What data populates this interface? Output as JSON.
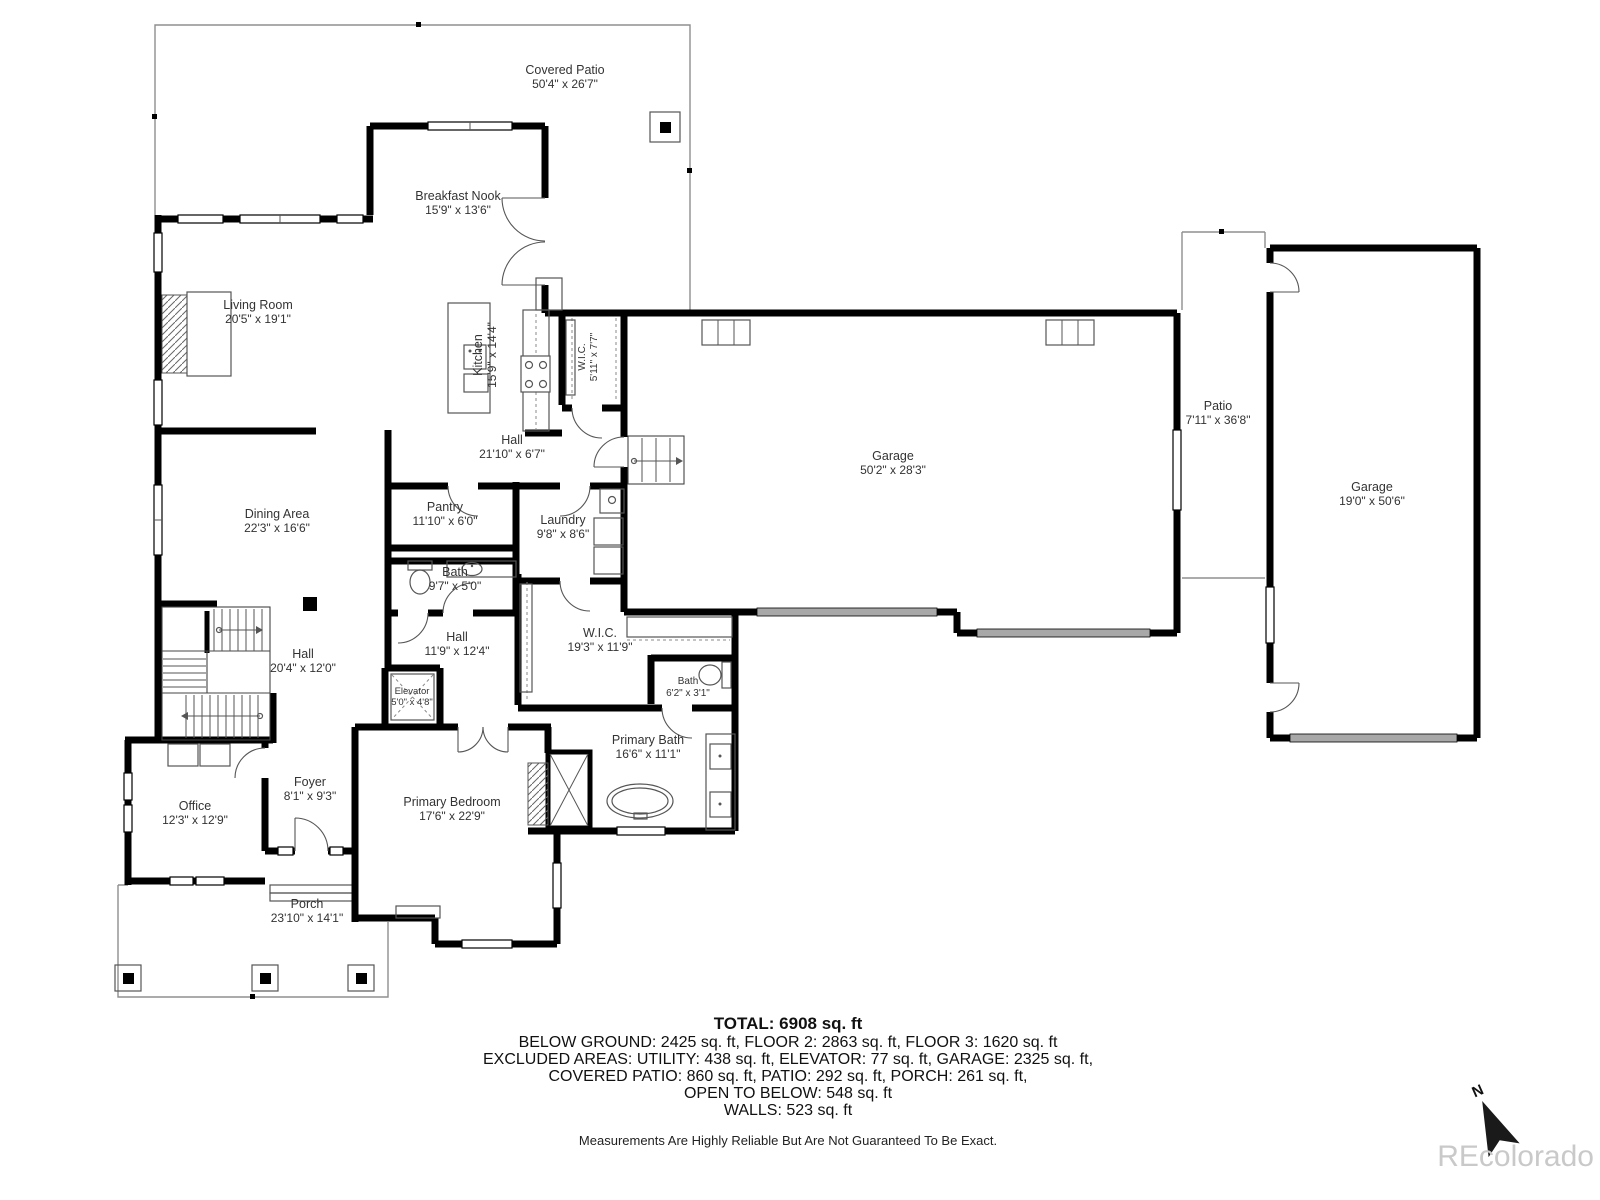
{
  "rooms": [
    {
      "name": "Covered Patio",
      "dims": "50'4\" x 26'7\""
    },
    {
      "name": "Breakfast Nook",
      "dims": "15'9\" x 13'6\""
    },
    {
      "name": "Living Room",
      "dims": "20'5\" x 19'1\""
    },
    {
      "name": "Kitchen",
      "dims": "15'9\" x 14'4\""
    },
    {
      "name": "W.I.C.",
      "dims": "5'11\" x 7'7\""
    },
    {
      "name": "Hall",
      "dims": "21'10\" x 6'7\""
    },
    {
      "name": "Garage",
      "dims": "50'2\" x 28'3\""
    },
    {
      "name": "Patio",
      "dims": "7'11\" x 36'8\""
    },
    {
      "name": "Garage",
      "dims": "19'0\" x 50'6\""
    },
    {
      "name": "Dining Area",
      "dims": "22'3\" x 16'6\""
    },
    {
      "name": "Pantry",
      "dims": "11'10\" x 6'0\""
    },
    {
      "name": "Laundry",
      "dims": "9'8\" x 8'6\""
    },
    {
      "name": "Bath",
      "dims": "9'7\" x 5'0\""
    },
    {
      "name": "Hall",
      "dims": "20'4\" x 12'0\""
    },
    {
      "name": "Hall",
      "dims": "11'9\" x 12'4\""
    },
    {
      "name": "W.I.C.",
      "dims": "19'3\" x 11'9\""
    },
    {
      "name": "Bath",
      "dims": "6'2\" x 3'1\""
    },
    {
      "name": "Elevator",
      "dims": "5'0\" x 4'8\""
    },
    {
      "name": "Primary Bath",
      "dims": "16'6\" x 11'1\""
    },
    {
      "name": "Primary Bedroom",
      "dims": "17'6\" x 22'9\""
    },
    {
      "name": "Office",
      "dims": "12'3\" x 12'9\""
    },
    {
      "name": "Foyer",
      "dims": "8'1\" x 9'3\""
    },
    {
      "name": "Porch",
      "dims": "23'10\" x 14'1\""
    }
  ],
  "summary": {
    "total": "TOTAL: 6908 sq. ft",
    "floors": "BELOW GROUND: 2425 sq. ft, FLOOR 2: 2863 sq. ft, FLOOR 3: 1620 sq. ft",
    "excluded1": "EXCLUDED AREAS: UTILITY: 438 sq. ft, ELEVATOR: 77 sq. ft, GARAGE: 2325 sq. ft,",
    "excluded2": "COVERED PATIO: 860 sq. ft, PATIO: 292 sq. ft, PORCH: 261 sq. ft,",
    "open_below": "OPEN TO BELOW: 548 sq. ft",
    "walls": "WALLS: 523 sq. ft",
    "disclaimer": "Measurements Are Highly Reliable But Are Not Guaranteed To Be Exact."
  },
  "watermark": "REcolorado",
  "compass": {
    "label": "N"
  },
  "colors": {
    "wall": "#000000",
    "label": "#333333",
    "garage_door": "#a8a8a8",
    "watermark": "#c9c9c9",
    "background": "#ffffff"
  }
}
